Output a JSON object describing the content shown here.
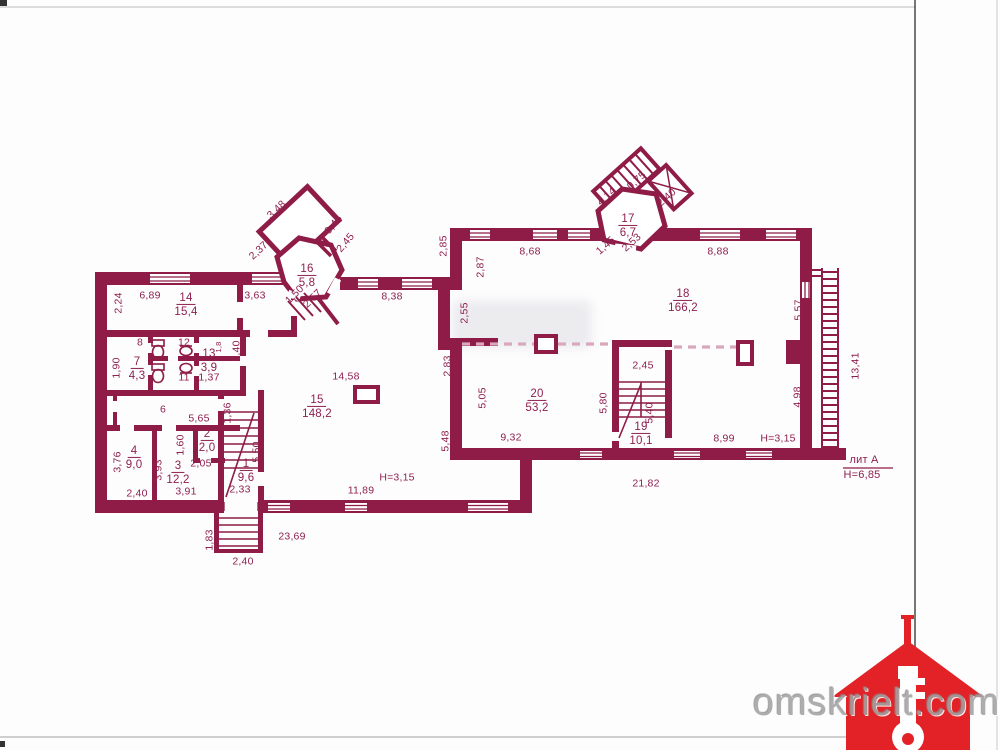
{
  "watermark": {
    "site": "omskrielt.com"
  },
  "annotations": {
    "liter": "лит А",
    "building_height": "H=6,85"
  },
  "colors": {
    "wall": "#8e1c46",
    "label": "#8e2050",
    "dashed_wall": "#d9a8bc",
    "house_red": "#e32227",
    "watermark_gray": "#a3a3a3"
  },
  "rooms_summary": [
    {
      "number": "1",
      "area": "9,6"
    },
    {
      "number": "2",
      "area": "2,0"
    },
    {
      "number": "3",
      "area": "12,2"
    },
    {
      "number": "4",
      "area": "9,0"
    },
    {
      "number": "7",
      "area": "4,3"
    },
    {
      "number": "13",
      "area": "3,9"
    },
    {
      "number": "14",
      "area": "15,4"
    },
    {
      "number": "15",
      "area": "148,2"
    },
    {
      "number": "16",
      "area": "5,8"
    },
    {
      "number": "17",
      "area": "6,7"
    },
    {
      "number": "18",
      "area": "166,2"
    },
    {
      "number": "19",
      "area": "10,1"
    },
    {
      "number": "20",
      "area": "53,2"
    }
  ],
  "labels": [
    {
      "n": "14",
      "a": "15,4",
      "x": 186,
      "y": 305
    },
    {
      "t": "6,89",
      "x": 150,
      "y": 296
    },
    {
      "t": "2,24",
      "x": 119,
      "y": 303,
      "r": -90
    },
    {
      "t": "3,63",
      "x": 255,
      "y": 296
    },
    {
      "n": "16",
      "a": "5,8",
      "x": 307,
      "y": 276
    },
    {
      "t": "3,48",
      "x": 277,
      "y": 210,
      "r": -43
    },
    {
      "t": "2,37",
      "x": 259,
      "y": 251,
      "r": -43
    },
    {
      "t": "0,45",
      "x": 334,
      "y": 225,
      "r": -50
    },
    {
      "t": "2,45",
      "x": 346,
      "y": 243,
      "r": -50
    },
    {
      "t": "1,50",
      "x": 295,
      "y": 295,
      "r": -45
    },
    {
      "t": "2,57",
      "x": 313,
      "y": 299,
      "r": -45
    },
    {
      "t": "8,38",
      "x": 392,
      "y": 297
    },
    {
      "t": "2,85",
      "x": 444,
      "y": 246,
      "r": -90
    },
    {
      "t": "2,87",
      "x": 481,
      "y": 267,
      "r": -90
    },
    {
      "t": "2,55",
      "x": 465,
      "y": 313,
      "r": -90
    },
    {
      "t": "8,68",
      "x": 530,
      "y": 252
    },
    {
      "n": "17",
      "a": "6,7",
      "x": 628,
      "y": 226
    },
    {
      "t": "4,14",
      "x": 607,
      "y": 197,
      "r": -42
    },
    {
      "t": "0,75",
      "x": 637,
      "y": 181,
      "r": -42
    },
    {
      "t": "2,40",
      "x": 667,
      "y": 198,
      "r": -42
    },
    {
      "t": "1,45",
      "x": 606,
      "y": 246,
      "r": -42
    },
    {
      "t": "2,53",
      "x": 632,
      "y": 243,
      "r": -42
    },
    {
      "t": "8,88",
      "x": 718,
      "y": 252
    },
    {
      "n": "18",
      "a": "166,2",
      "x": 683,
      "y": 301
    },
    {
      "t": "5,57",
      "x": 799,
      "y": 310,
      "r": -90
    },
    {
      "t": "13,41",
      "x": 856,
      "y": 366,
      "r": -90
    },
    {
      "t": "4,98",
      "x": 798,
      "y": 397,
      "r": -90
    },
    {
      "t": "2,45",
      "x": 643,
      "y": 366
    },
    {
      "t": "5,80",
      "x": 604,
      "y": 403,
      "r": -90
    },
    {
      "t": "5,40",
      "x": 650,
      "y": 413,
      "r": -90
    },
    {
      "n": "19",
      "a": "10,1",
      "x": 641,
      "y": 434
    },
    {
      "n": "20",
      "a": "53,2",
      "x": 537,
      "y": 401
    },
    {
      "t": "5,05",
      "x": 483,
      "y": 398,
      "r": -90
    },
    {
      "t": "9,32",
      "x": 511,
      "y": 438
    },
    {
      "t": "2,83",
      "x": 448,
      "y": 366,
      "r": -90
    },
    {
      "t": "5,48",
      "x": 446,
      "y": 441,
      "r": -90
    },
    {
      "t": "8,99",
      "x": 724,
      "y": 439
    },
    {
      "t": "H=3,15",
      "x": 778,
      "y": 439
    },
    {
      "t": "21,82",
      "x": 646,
      "y": 484
    },
    {
      "t": "лит А",
      "x": 864,
      "y": 461,
      "cls": "lit",
      "name": "liter-label"
    },
    {
      "t": "H=6,85",
      "x": 862,
      "y": 476,
      "cls": "lit",
      "name": "building-height-label"
    },
    {
      "t": "H=3,15",
      "x": 397,
      "y": 478
    },
    {
      "t": "11,89",
      "x": 361,
      "y": 491
    },
    {
      "n": "15",
      "a": "148,2",
      "x": 317,
      "y": 407
    },
    {
      "t": "14,58",
      "x": 346,
      "y": 377
    },
    {
      "t": "23,69",
      "x": 292,
      "y": 537
    },
    {
      "t": "2,40",
      "x": 243,
      "y": 562
    },
    {
      "t": "1,83",
      "x": 210,
      "y": 540,
      "r": -90
    },
    {
      "t": "3,91",
      "x": 186,
      "y": 492
    },
    {
      "t": "2,33",
      "x": 240,
      "y": 490
    },
    {
      "n": "1",
      "a": "9,6",
      "x": 246,
      "y": 471
    },
    {
      "t": "5,50",
      "x": 257,
      "y": 452,
      "r": -90
    },
    {
      "n": "2",
      "a": "2,0",
      "x": 207,
      "y": 441
    },
    {
      "t": "1,60",
      "x": 181,
      "y": 445,
      "r": -90
    },
    {
      "t": "2,05",
      "x": 201,
      "y": 464
    },
    {
      "n": "3",
      "a": "12,2",
      "x": 178,
      "y": 473
    },
    {
      "t": "3,93",
      "x": 159,
      "y": 470,
      "r": -90
    },
    {
      "n": "4",
      "a": "9,0",
      "x": 134,
      "y": 458
    },
    {
      "t": "3,76",
      "x": 118,
      "y": 462,
      "r": -90
    },
    {
      "t": "2,40",
      "x": 137,
      "y": 494
    },
    {
      "t": "5",
      "x": 101,
      "y": 415
    },
    {
      "t": "6",
      "x": 163,
      "y": 410
    },
    {
      "t": "5,65",
      "x": 199,
      "y": 419
    },
    {
      "t": "1,36",
      "x": 228,
      "y": 413,
      "r": -90
    },
    {
      "n": "7",
      "a": "4,3",
      "x": 137,
      "y": 369
    },
    {
      "t": "1,90",
      "x": 117,
      "y": 368,
      "r": -90
    },
    {
      "t": "8",
      "x": 140,
      "y": 343
    },
    {
      "t": "12",
      "x": 184,
      "y": 343
    },
    {
      "t": "11",
      "x": 184,
      "y": 378
    },
    {
      "n": "13",
      "a": "3,9",
      "x": 209,
      "y": 361
    },
    {
      "t": "1,37",
      "x": 209,
      "y": 378
    },
    {
      "t": "5,40",
      "x": 237,
      "y": 351,
      "r": -90
    },
    {
      "t": "1,8",
      "x": 219,
      "y": 347,
      "r": -90,
      "cls": "tiny"
    }
  ]
}
